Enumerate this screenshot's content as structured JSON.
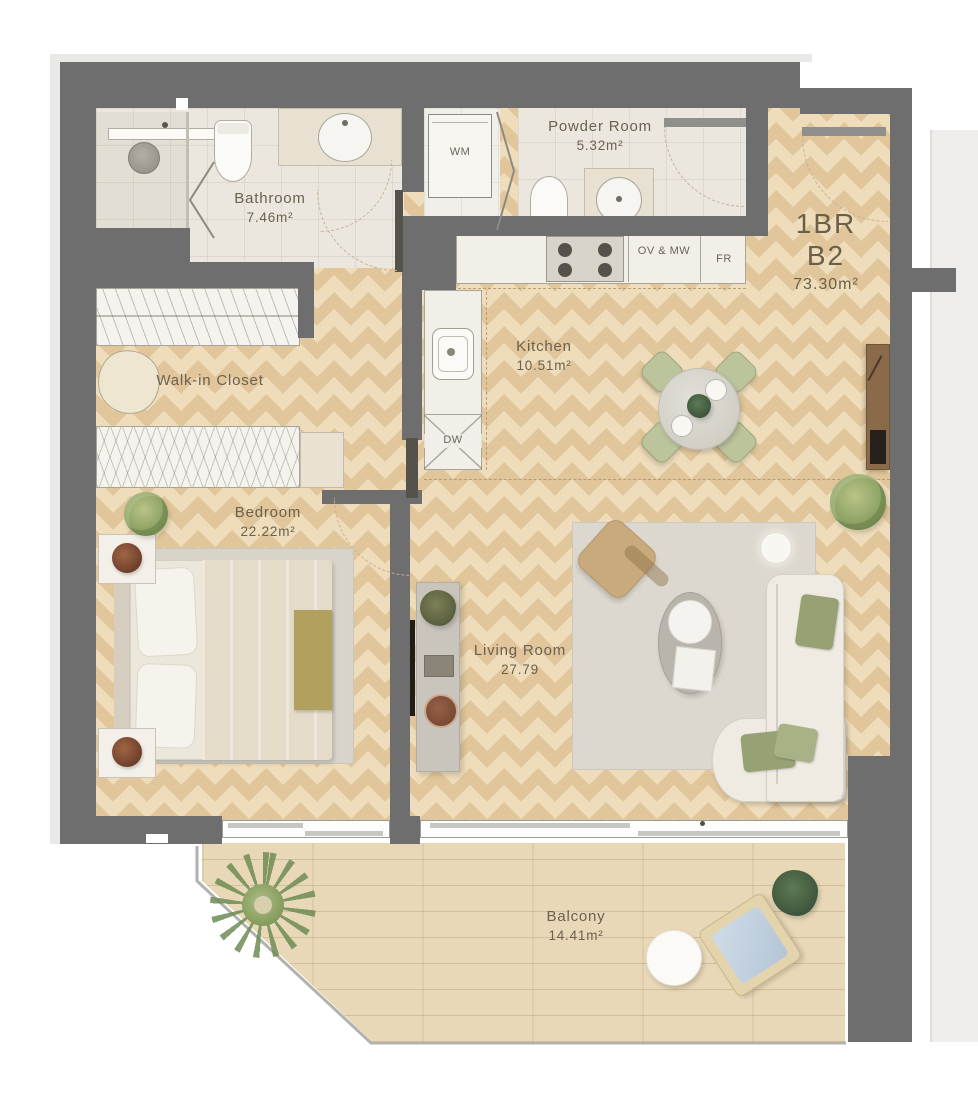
{
  "unit": {
    "type": "1BR",
    "variant": "B2",
    "total_area": "73.30m²"
  },
  "rooms": {
    "bathroom": {
      "name": "Bathroom",
      "area": "7.46m²"
    },
    "powder_room": {
      "name": "Powder Room",
      "area": "5.32m²"
    },
    "walk_in_closet": {
      "name": "Walk-in Closet"
    },
    "kitchen": {
      "name": "Kitchen",
      "area": "10.51m²"
    },
    "bedroom": {
      "name": "Bedroom",
      "area": "22.22m²"
    },
    "living_room": {
      "name": "Living Room",
      "area": "27.79"
    },
    "balcony": {
      "name": "Balcony",
      "area": "14.41m²"
    }
  },
  "appliances": {
    "washing_machine": "WM",
    "oven_microwave": "OV & MW",
    "fridge": "FR",
    "dishwasher": "DW"
  },
  "colors": {
    "wall": "#6e6e6e",
    "wood_floor": "#eedcba",
    "wood_chevron": "#e2c89b",
    "tile_floor": "#ebe7de",
    "balcony_deck": "#e8d8b7",
    "label_text": "#6b6150",
    "dashed_line": "#c8b194"
  }
}
